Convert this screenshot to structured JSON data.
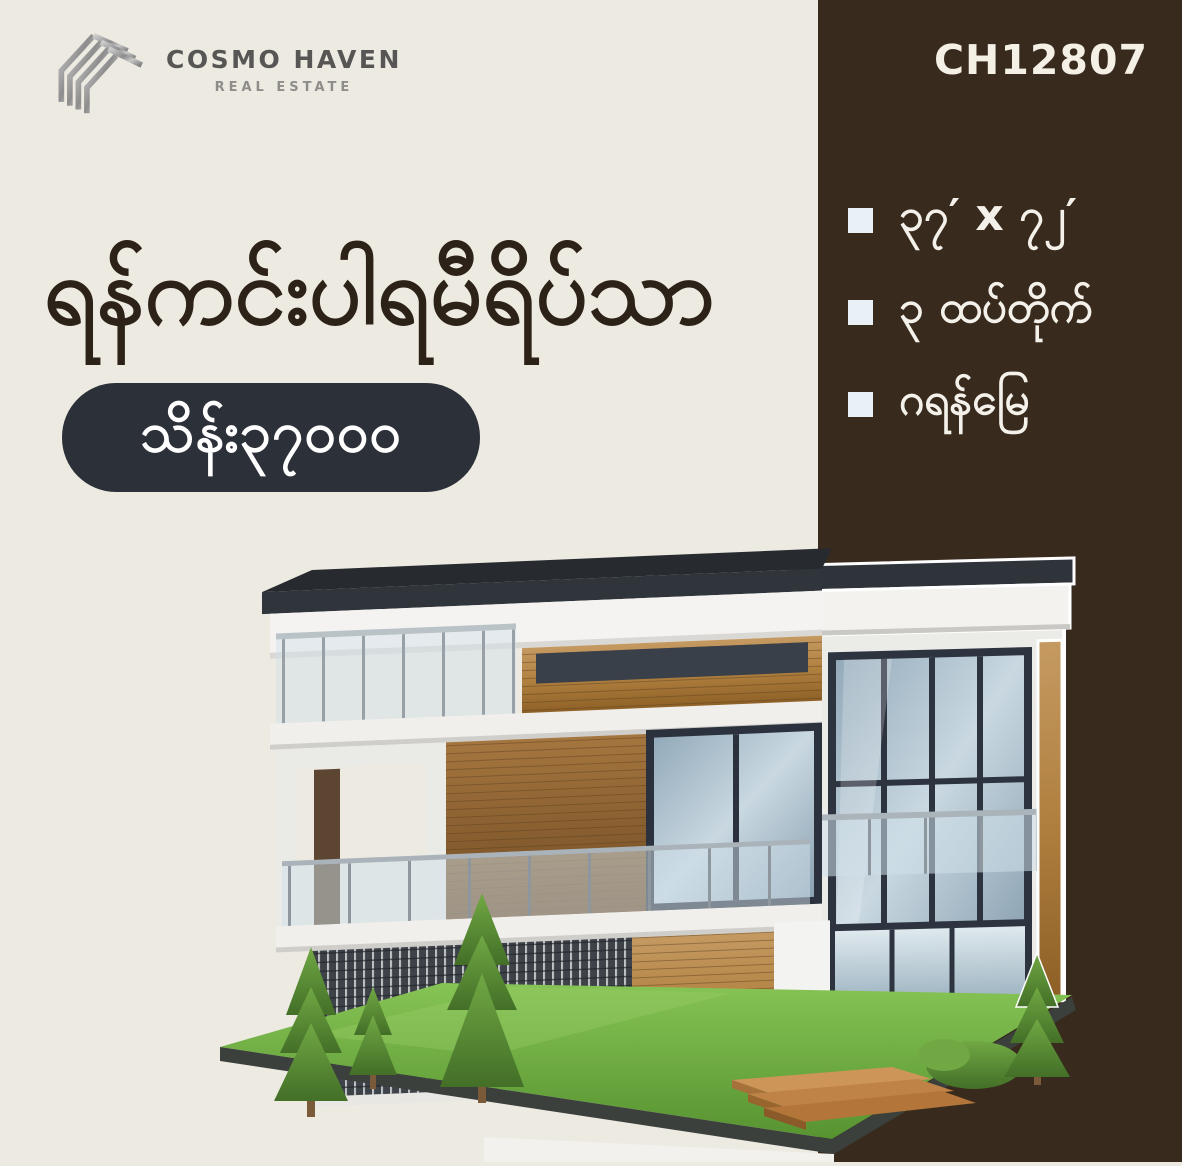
{
  "brand": {
    "name": "COSMO HAVEN",
    "tagline": "REAL ESTATE",
    "logo_icon": "chevron-stack-logo"
  },
  "listing_code": "CH12807",
  "headline": "ရန်ကင်းပါရမီရိပ်သာ",
  "price_badge": "သိန်း၃၇၀၀၀",
  "features": [
    {
      "icon": "square-bullet-icon",
      "label": "၃၇′ x ၇၂′"
    },
    {
      "icon": "square-bullet-icon",
      "label": "၃ ထပ်တိုက်"
    },
    {
      "icon": "square-bullet-icon",
      "label": "ဂရန်မြေ"
    }
  ],
  "illustration": {
    "name": "modern-three-storey-house",
    "elements": [
      "flat dark roof",
      "glass balconies",
      "wood cladding",
      "large windows",
      "slatted grille wall",
      "wooden steps",
      "lawn",
      "conifer trees",
      "shrub"
    ]
  },
  "colors": {
    "background": "#edeae2",
    "side_panel": "#382a1d",
    "headline_text": "#2d2217",
    "badge_background": "#2c3038",
    "badge_text": "#ffffff",
    "panel_text": "#f4f1ea",
    "bullet": "#eaf1f6",
    "grass": "#6fae3d",
    "wood": "#b9854d",
    "roof": "#30353b"
  }
}
